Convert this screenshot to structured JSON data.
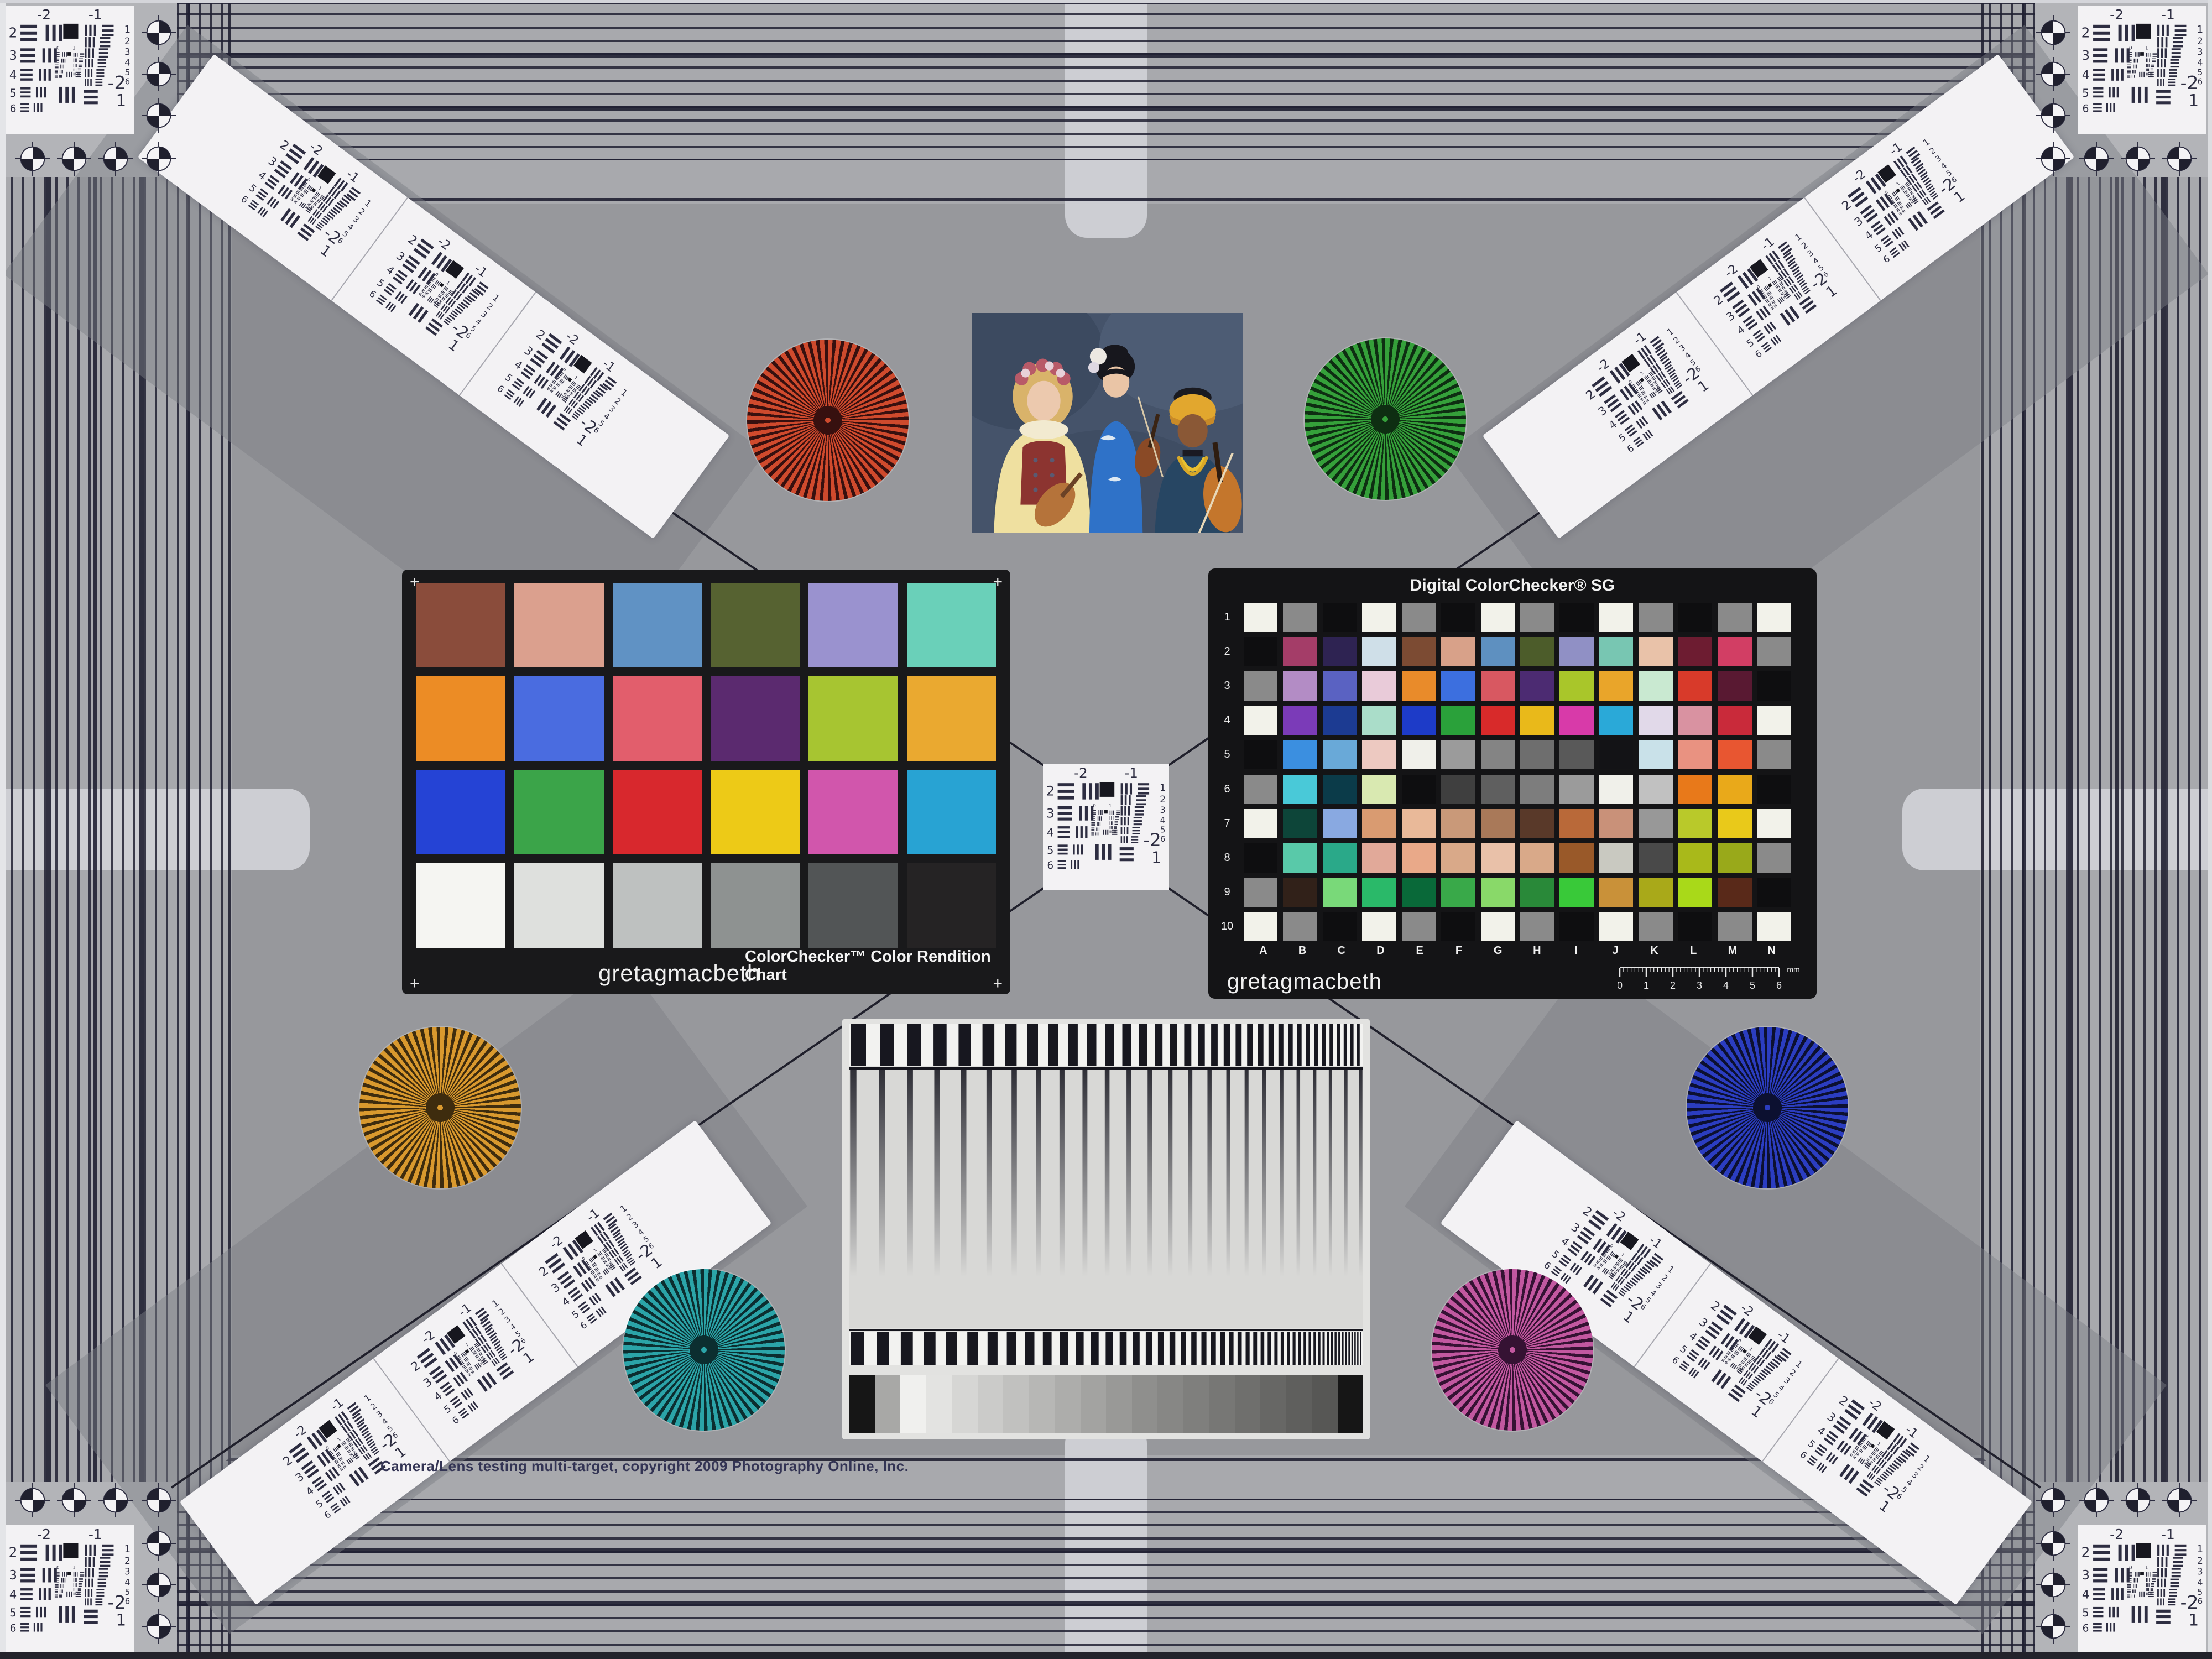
{
  "meta": {
    "copyright": "Camera/Lens testing multi-target, copyright 2009 Photography Online, Inc."
  },
  "colorchecker": {
    "brand": "gretagmacbeth",
    "title": "ColorChecker™ Color Rendition Chart",
    "corner_mark": "+",
    "rows": [
      [
        "#8a4c3b",
        "#dba08e",
        "#6092c4",
        "#566231",
        "#9a92cf",
        "#6ad0b9"
      ],
      [
        "#ec8c25",
        "#4a6ce0",
        "#e25e6c",
        "#5b2a6f",
        "#a7c531",
        "#eaa930"
      ],
      [
        "#2543d5",
        "#3ba449",
        "#d8282d",
        "#edca17",
        "#d156ac",
        "#28a3d3"
      ],
      [
        "#f5f5f2",
        "#dee0dd",
        "#bec1c0",
        "#8e9291",
        "#525556",
        "#252324"
      ]
    ]
  },
  "sg": {
    "title": "Digital ColorChecker® SG",
    "brand": "gretagmacbeth",
    "row_labels": [
      "1",
      "2",
      "3",
      "4",
      "5",
      "6",
      "7",
      "8",
      "9",
      "10"
    ],
    "col_labels": [
      "A",
      "B",
      "C",
      "D",
      "E",
      "F",
      "G",
      "H",
      "I",
      "J",
      "K",
      "L",
      "M",
      "N"
    ],
    "ruler_ticks": [
      "0",
      "1",
      "2",
      "3",
      "4",
      "5",
      "6"
    ],
    "ruler_unit": "mm",
    "patches": [
      [
        "#f2f2ea",
        "#8a8a8a",
        "#0e0e10",
        "#f2f2ea",
        "#8a8a8a",
        "#0e0e10",
        "#f2f2ea",
        "#8a8a8a",
        "#0e0e10",
        "#f2f2ea",
        "#8a8a8a",
        "#0e0e10",
        "#8a8a8a",
        "#f2f2ea"
      ],
      [
        "#0e0e10",
        "#a43d68",
        "#2e2352",
        "#cfdfe8",
        "#7c4b33",
        "#d8a189",
        "#5e90c0",
        "#4c5c2a",
        "#9090c5",
        "#78c6b2",
        "#e9c2a9",
        "#6d1c31",
        "#d23e64",
        "#8a8a8a"
      ],
      [
        "#8a8a8a",
        "#b38cc5",
        "#5a62c2",
        "#e9cbd9",
        "#e98b2a",
        "#3c6fdf",
        "#d85861",
        "#4c2b72",
        "#a9c62a",
        "#e9a52a",
        "#c9e9d1",
        "#d83a2a",
        "#591932",
        "#0e0e10"
      ],
      [
        "#f2f2ea",
        "#7b3bb8",
        "#1c3b92",
        "#aaddc9",
        "#1d3bc8",
        "#2aa13a",
        "#d82a2a",
        "#e9b91a",
        "#d83aa9",
        "#2aa9d8",
        "#e1d9e9",
        "#d992a1",
        "#c92a3a",
        "#f2f2ea"
      ],
      [
        "#0e0e10",
        "#3b8fe0",
        "#69a9d8",
        "#edc9c1",
        "#f0f0ea",
        "#9b9b9b",
        "#848484",
        "#6e6e6e",
        "#595959",
        "#131316",
        "#c9e1e9",
        "#e99281",
        "#e85631",
        "#8a8a8a"
      ],
      [
        "#8a8a8a",
        "#49c9d8",
        "#0b3b49",
        "#d9e9b1",
        "#0e0e10",
        "#3f3f3f",
        "#5f5f5f",
        "#7d7d7d",
        "#9b9b9b",
        "#f0f0ea",
        "#c1c1c1",
        "#e8791a",
        "#e9a91a",
        "#0e0e10"
      ],
      [
        "#f2f2ea",
        "#0d4539",
        "#89a9e1",
        "#d99b71",
        "#e9b999",
        "#c99979",
        "#a97959",
        "#593929",
        "#b96939",
        "#c99179",
        "#989898",
        "#b9c92a",
        "#e9c91a",
        "#f2f2ea"
      ],
      [
        "#0e0e10",
        "#59c9a9",
        "#2aa989",
        "#e1a999",
        "#e9a989",
        "#d9a989",
        "#e9c1a9",
        "#d9a989",
        "#995929",
        "#c9c9c1",
        "#494949",
        "#a9b91a",
        "#99a91a",
        "#8a8a8a"
      ],
      [
        "#8a8a8a",
        "#312119",
        "#79d979",
        "#2ab969",
        "#096939",
        "#39a949",
        "#89d969",
        "#298939",
        "#39c939",
        "#c99139",
        "#a9a919",
        "#a9d919",
        "#592919",
        "#0e0e10"
      ],
      [
        "#f2f2ea",
        "#8a8a8a",
        "#0e0e10",
        "#f2f2ea",
        "#8a8a8a",
        "#0e0e10",
        "#f2f2ea",
        "#8a8a8a",
        "#0e0e10",
        "#f2f2ea",
        "#8a8a8a",
        "#0e0e10",
        "#8a8a8a",
        "#f2f2ea"
      ]
    ]
  },
  "usaf": {
    "top_labels": [
      "-2",
      "-1"
    ],
    "left_labels": [
      "2",
      "3",
      "4",
      "5",
      "6"
    ],
    "right_labels": [
      "1",
      "2",
      "3",
      "4",
      "5",
      "6"
    ],
    "bottom_labels": [
      "-2",
      "1"
    ],
    "inner_labels": [
      "0",
      "1"
    ]
  },
  "stars": [
    {
      "name": "red-star",
      "fg": "#cf4a2d",
      "bg": "#37100f"
    },
    {
      "name": "green-star",
      "fg": "#35a03a",
      "bg": "#0e2e12"
    },
    {
      "name": "amber-star",
      "fg": "#d9992e",
      "bg": "#3e2c0e"
    },
    {
      "name": "blue-star",
      "fg": "#2b3dc0",
      "bg": "#0c1030"
    },
    {
      "name": "teal-star",
      "fg": "#2ba4a8",
      "bg": "#0c2e30"
    },
    {
      "name": "magenta-star",
      "fg": "#c258a0",
      "bg": "#351233"
    }
  ],
  "gray_steps": [
    "#161616",
    "#a8a8a6",
    "#f0f0ee",
    "#e3e3e1",
    "#d6d6d4",
    "#cbcbc9",
    "#c1c1bf",
    "#b7b7b5",
    "#adadab",
    "#a3a3a1",
    "#999997",
    "#8f8f8d",
    "#878785",
    "#7f7f7d",
    "#777775",
    "#6f6f6d",
    "#676765",
    "#5f5f5d",
    "#575755",
    "#161616"
  ]
}
